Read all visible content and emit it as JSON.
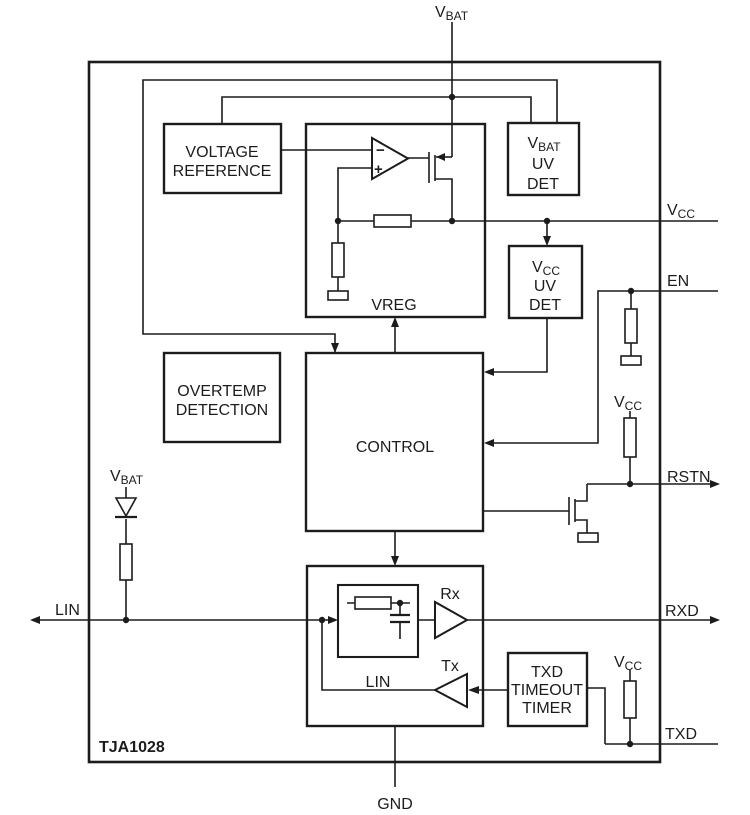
{
  "chip": {
    "name": "TJA1028"
  },
  "pins": {
    "vbat": {
      "base": "V",
      "sub": "BAT"
    },
    "vcc": {
      "base": "V",
      "sub": "CC"
    },
    "en": {
      "label": "EN"
    },
    "rstn": {
      "label": "RSTN"
    },
    "rxd": {
      "label": "RXD"
    },
    "txd": {
      "label": "TXD"
    },
    "lin": {
      "label": "LIN"
    },
    "gnd": {
      "label": "GND"
    }
  },
  "blocks": {
    "voltage_reference": {
      "line1": "VOLTAGE",
      "line2": "REFERENCE"
    },
    "vreg": {
      "label": "VREG"
    },
    "vbat_uv_det": {
      "base": "V",
      "sub": "BAT",
      "line2": "UV",
      "line3": "DET"
    },
    "vcc_uv_det": {
      "base": "V",
      "sub": "CC",
      "line2": "UV",
      "line3": "DET"
    },
    "overtemp": {
      "line1": "OVERTEMP",
      "line2": "DETECTION"
    },
    "control": {
      "label": "CONTROL"
    },
    "lin_stage": {
      "label": "LIN"
    },
    "txd_timer": {
      "line1": "TXD",
      "line2": "TIMEOUT",
      "line3": "TIMER"
    },
    "rx": {
      "label": "Rx"
    },
    "tx": {
      "label": "Tx"
    }
  },
  "rails": {
    "lin_pullup_vbat": {
      "base": "V",
      "sub": "BAT"
    },
    "rstn_pullup_vcc": {
      "base": "V",
      "sub": "CC"
    },
    "txd_pullup_vcc": {
      "base": "V",
      "sub": "CC"
    }
  },
  "opamp": {
    "minus": "−",
    "plus": "+"
  },
  "colors": {
    "ink": "#1c1c1c",
    "background": "#ffffff"
  }
}
